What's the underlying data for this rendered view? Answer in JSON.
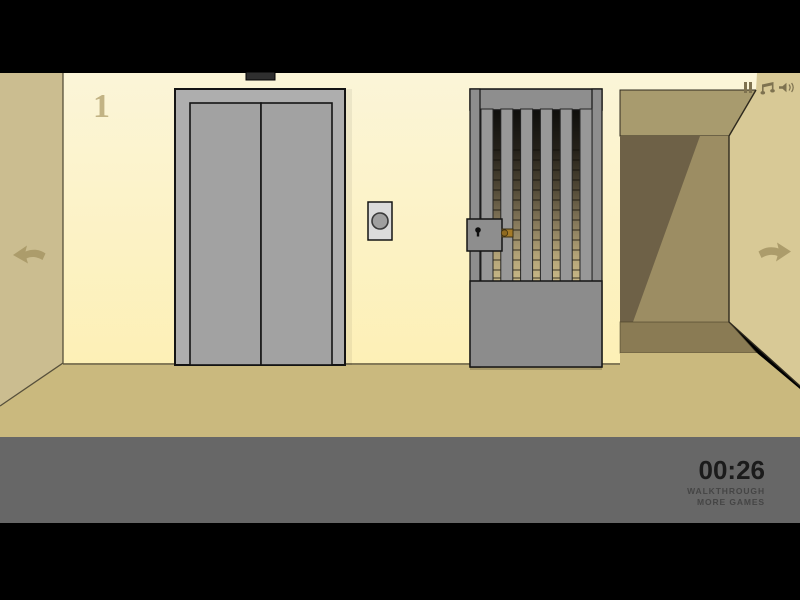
{
  "scene": {
    "floor_number": "1",
    "location": "elevator hallway with barred stairway gate"
  },
  "hud": {
    "timer": "00:26",
    "walkthrough_label": "WALKTHROUGH",
    "more_games_label": "MORE GAMES",
    "icons": {
      "pause": "pause-icon",
      "music": "music-note-icon",
      "sound": "speaker-icon"
    }
  },
  "nav": {
    "left": "left-arrow-icon",
    "right": "right-arrow-icon"
  },
  "colors": {
    "wallTop": "#FBF5D8",
    "wallBottom": "#FDF0B6",
    "leftWall": "#CBBD90",
    "rightWall": "#D8C996",
    "floor": "#CAB97E",
    "ceiling": "#A89B6E",
    "corridorDark": "#6E6147",
    "corridorLight": "#9C8D63",
    "corridorShadow": "#8A7B54",
    "elevFrame": "#AEAEAE",
    "elevDoor": "#A2A2A2",
    "gateGray": "#8E8E8E",
    "gateBar": "#989898",
    "gatePanel": "#8C8C8C",
    "stairTop": "#0E0E0C",
    "stairBottom": "#C8B887",
    "hudBand": "#676767",
    "hudIcon": "#7E7250",
    "arrow": "#AC9C6B",
    "latch": "#A57B28",
    "buttonPlate": "#DBDBDB",
    "buttonCircle": "#A0A0A0",
    "indicator": "#2F2F2F",
    "timerText": "#1B1B1B",
    "linkText": "#454545",
    "floorNum": "#C2B384",
    "outline": "#141414"
  }
}
